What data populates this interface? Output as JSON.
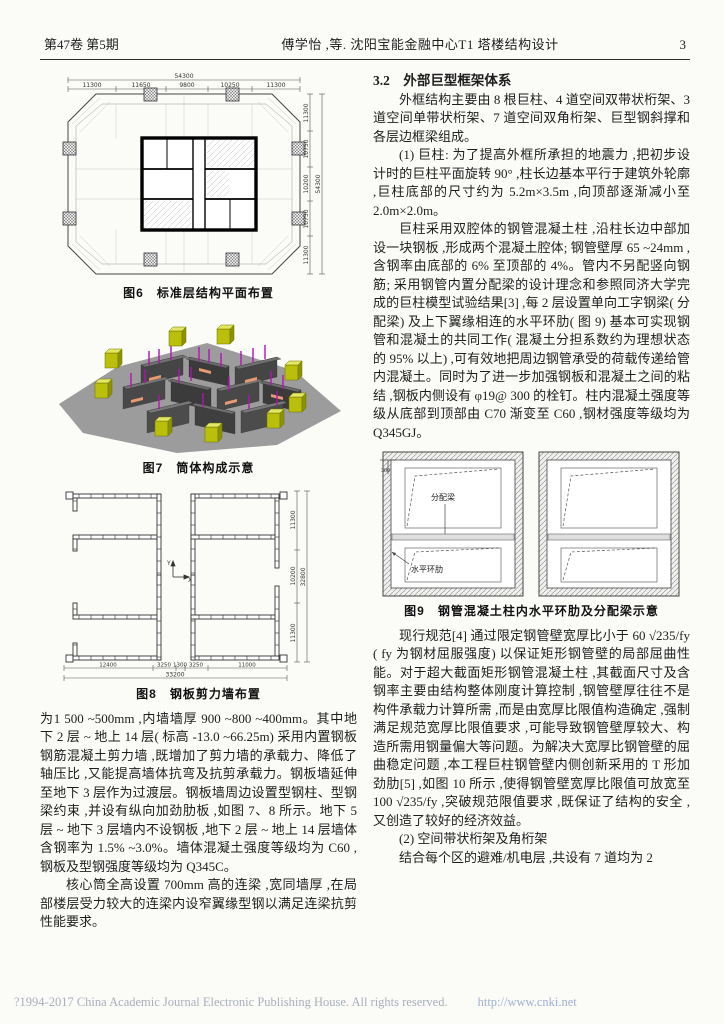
{
  "header": {
    "volume_issue": "第47卷 第5期",
    "running_title": "傅学怡 ,等. 沈阳宝能金融中心T1 塔楼结构设计",
    "page_number": "3"
  },
  "left": {
    "fig6": {
      "caption": "图6　标准层结构平面布置",
      "top_total": "54300",
      "top_dims": [
        "11300",
        "11650",
        "9800",
        "10250",
        "11300"
      ],
      "right_dims": [
        "11300",
        "10750",
        "10200",
        "10750",
        "11300"
      ],
      "right_total": "54300"
    },
    "fig7": {
      "caption": "图7　筒体构成示意"
    },
    "fig8": {
      "caption": "图8　钢板剪力墙布置",
      "bottom_dims": [
        "12400",
        "3250",
        "1300",
        "3250",
        "11000"
      ],
      "bottom_total": "33200",
      "right_dims": [
        "11300",
        "10200",
        "11300"
      ],
      "right_total": "32800",
      "axis_y": "Y",
      "axis_x": "X"
    },
    "paragraphs": [
      "为1 500 ~500mm ,内墙墙厚 900 ~800 ~400mm。其中地下 2 层 ~ 地上 14 层( 标高 -13.0 ~66.25m) 采用内置钢板钢筋混凝土剪力墙 ,既增加了剪力墙的承载力、降低了轴压比 ,又能提高墙体抗弯及抗剪承载力。钢板墙延伸至地下 3 层作为过渡层。钢板墙周边设置型钢柱、型钢梁约束 ,并设有纵向加劲肋板 ,如图 7、8 所示。地下 5 层 ~ 地下 3 层墙内不设钢板 ,地下 2 层 ~ 地上 14 层墙体含钢率为 1.5% ~3.0%。墙体混凝土强度等级均为 C60 ,钢板及型钢强度等级均为 Q345C。",
      "核心筒全高设置 700mm 高的连梁 ,宽同墙厚 ,在局部楼层受力较大的连梁内设窄翼缘型钢以满足连梁抗剪性能要求。"
    ]
  },
  "right": {
    "section_heading": "3.2　外部巨型框架体系",
    "paragraphs_before_fig9": [
      "外框结构主要由 8 根巨柱、4 道空间双带状桁架、3 道空间单带状桁架、7 道空间双角桁架、巨型钢斜撑和各层边框梁组成。",
      "(1) 巨柱: 为了提高外框所承担的地震力 ,把初步设计时的巨柱平面旋转 90° ,柱长边基本平行于建筑外轮廓 ,巨柱底部的尺寸约为 5.2m×3.5m ,向顶部逐渐减小至 2.0m×2.0m。",
      "巨柱采用双腔体的钢管混凝土柱 ,沿柱长边中部加设一块钢板 ,形成两个混凝土腔体; 钢管壁厚 65 ~24mm ,含钢率由底部的 6% 至顶部的 4%。管内不另配竖向钢筋; 采用钢管内置分配梁的设计理念和参照同济大学完成的巨柱模型试验结果[3] ,每 2 层设置单向工字钢梁( 分配梁) 及上下翼缘相连的水平环肋( 图 9) 基本可实现钢管和混凝土的共同工作( 混凝土分担系数约为理想状态的 95% 以上) ,可有效地把周边钢管承受的荷载传递给管内混凝土。同时为了进一步加强钢板和混凝土之间的粘结 ,钢板内侧设有 φ19@ 300 的栓钉。柱内混凝土强度等级从底部到顶部由 C70 渐变至 C60 ,钢材强度等级均为 Q345GJ。"
    ],
    "fig9": {
      "caption": "图9　钢管混凝土柱内水平环肋及分配梁示意",
      "beam_label": "分配梁",
      "rib_label": "水平环肋",
      "dim300": "300"
    },
    "paragraphs_after_fig9": [
      "现行规范[4] 通过限定钢管壁宽厚比小于 60 √235/fy ( fy 为钢材屈服强度) 以保证矩形钢管壁的局部屈曲性能。对于超大截面矩形钢管混凝土柱 ,其截面尺寸及含钢率主要由结构整体刚度计算控制 ,钢管壁厚往往不是构件承载力计算所需 ,而是由宽厚比限值构造确定 ,强制满足规范宽厚比限值要求 ,可能导致钢管壁厚较大、构造所需用钢量偏大等问题。为解决大宽厚比钢管壁的屈曲稳定问题 ,本工程巨柱钢管壁内侧创新采用的 T 形加劲肋[5] ,如图 10 所示 ,使得钢管壁宽厚比限值可放宽至 100 √235/fy ,突破规范限值要求 ,既保证了结构的安全 ,又创造了较好的经济效益。",
      "(2) 空间带状桁架及角桁架",
      "结合每个区的避难/机电层 ,共设有 7 道均为 2"
    ]
  },
  "footer": {
    "copyright": "?1994-2017 China Academic Journal Electronic Publishing House. All rights reserved.",
    "url": "http://www.cnki.net"
  },
  "colors": {
    "base_gray": "#9c9c9c",
    "wall_dark": "#454545",
    "column_yellow": "#b9bf0a",
    "stud_magenta": "#b312b3",
    "clip_orange": "#e89a72"
  }
}
